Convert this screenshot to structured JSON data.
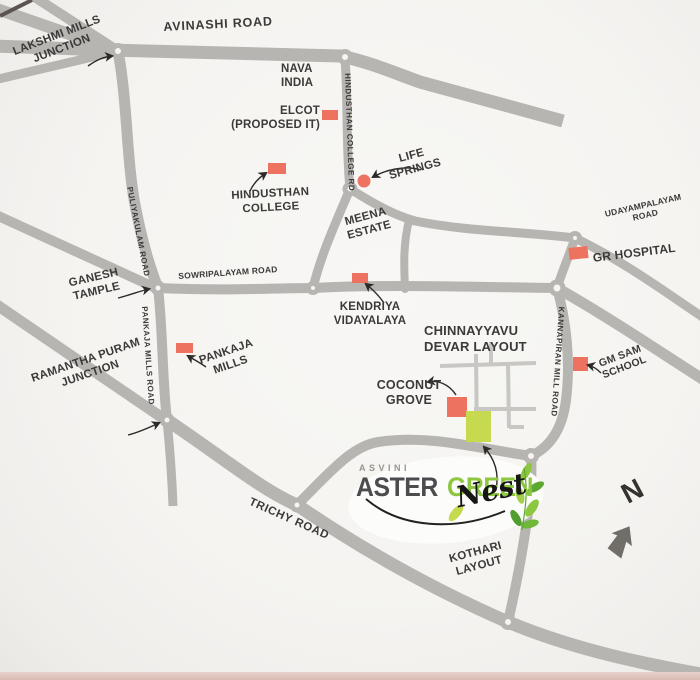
{
  "logo": {
    "brand": "ASVINI",
    "name_primary": "ASTER",
    "name_secondary": "GREEN",
    "name_script": "Nest"
  },
  "compass": {
    "label": "N"
  },
  "roads": {
    "avinashi": "AVINASHI ROAD",
    "hindusthan_college": "HINDUSTHAN COLLEGE RD",
    "puliyakulam": "PULIYAKULAM ROAD",
    "sowripalayam": "SOWRIPALAYAM ROAD",
    "pankaja_mills": "PANKAJA MILLS ROAD",
    "udayampalayam_line1": "UDAYAMPALAYAM",
    "udayampalayam_line2": "ROAD",
    "kannapiran": "KANNAPIRAN MILL ROAD",
    "trichy": "TRICHY ROAD"
  },
  "junctions": {
    "lakshmi_line1": "LAKSHMI MILLS",
    "lakshmi_line2": "JUNCTION",
    "ramantha_line1": "RAMANTHA PURAM",
    "ramantha_line2": "JUNCTION"
  },
  "landmarks": {
    "nava_line1": "NAVA",
    "nava_line2": "INDIA",
    "elcot_line1": "ELCOT",
    "elcot_line2": "(PROPOSED IT)",
    "life_line1": "LIFE",
    "life_line2": "SPRINGS",
    "hindusthan_line1": "HINDUSTHAN",
    "hindusthan_line2": "COLLEGE",
    "meena_line1": "MEENA",
    "meena_line2": "ESTATE",
    "gr_hospital": "GR HOSPITAL",
    "ganesh_line1": "GANESH",
    "ganesh_line2": "TAMPLE",
    "kendriya_line1": "KENDRIYA",
    "kendriya_line2": "VIDAYALAYA",
    "chinnayyavu_line1": "CHINNAYYAVU",
    "chinnayyavu_line2": "DEVAR LAYOUT",
    "pankaja_line1": "PANKAJA",
    "pankaja_line2": "MILLS",
    "gmsam_line1": "GM SAM",
    "gmsam_line2": "SCHOOL",
    "coconut_line1": "COCONUT",
    "coconut_line2": "GROVE",
    "kothari_line1": "KOTHARI",
    "kothari_line2": "LAYOUT"
  },
  "colors": {
    "road": "#b7b5b2",
    "landmark_marker": "#ee7260",
    "site_marker": "#c6d94f",
    "logo_green": "#8dc63f",
    "text": "#3b3a38"
  }
}
